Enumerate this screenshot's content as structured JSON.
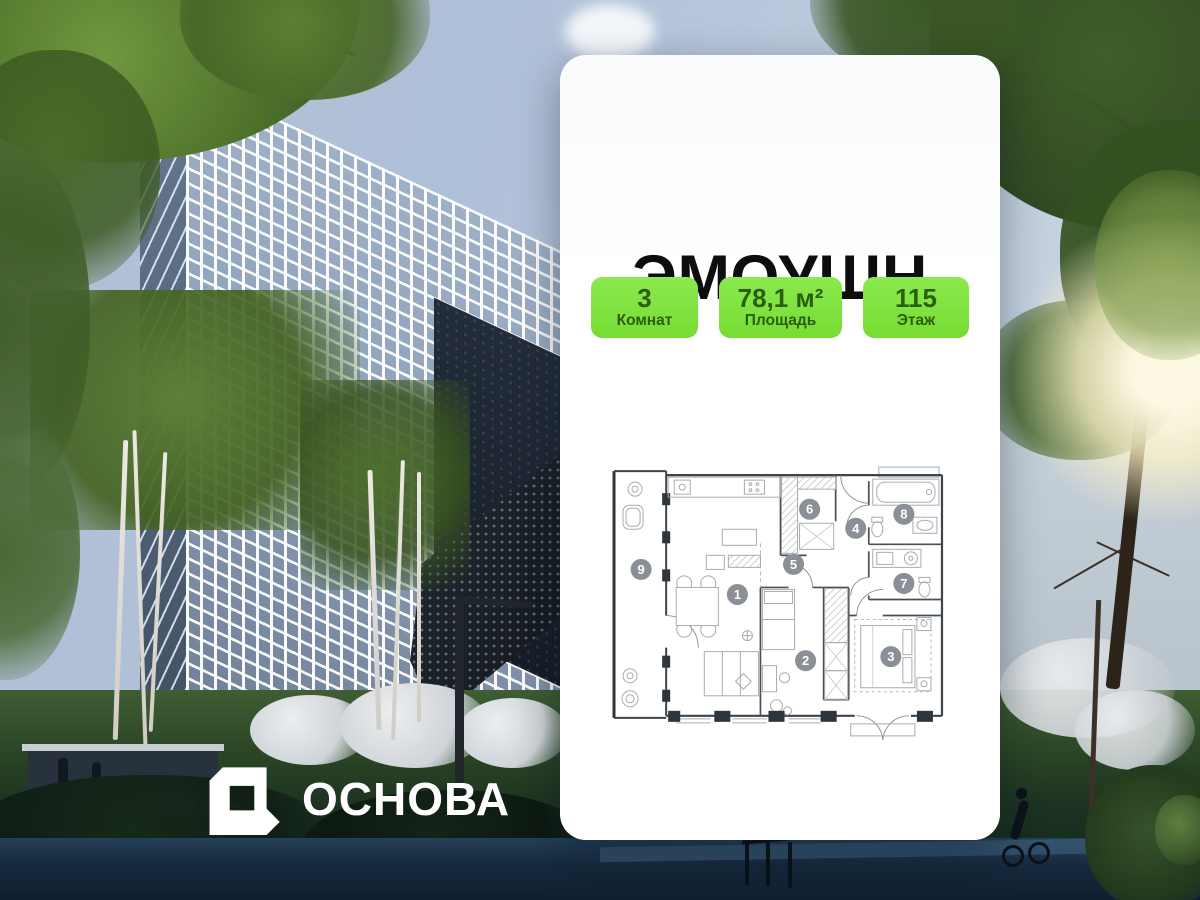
{
  "card": {
    "title": "ЭМОУШН",
    "badges": [
      {
        "value": "3",
        "label": "Комнат"
      },
      {
        "value": "78,1 м²",
        "label": "Площадь"
      },
      {
        "value": "115",
        "label": "Этаж"
      }
    ]
  },
  "floorplan": {
    "description": "apartment-plan",
    "rooms": [
      {
        "number": "1",
        "x": 127,
        "y": 129
      },
      {
        "number": "2",
        "x": 195,
        "y": 195
      },
      {
        "number": "3",
        "x": 280,
        "y": 191
      },
      {
        "number": "4",
        "x": 245,
        "y": 63
      },
      {
        "number": "5",
        "x": 183,
        "y": 99
      },
      {
        "number": "6",
        "x": 199,
        "y": 44
      },
      {
        "number": "7",
        "x": 293,
        "y": 118
      },
      {
        "number": "8",
        "x": 293,
        "y": 49
      },
      {
        "number": "9",
        "x": 31,
        "y": 104
      }
    ]
  },
  "brand": {
    "name": "ОСНОВА"
  },
  "colors": {
    "badge_bg": "#77DC33",
    "badge_bg_light": "#8BE94F",
    "badge_text": "#2A5F10",
    "title": "#0C0D0E",
    "room_marker": "#8B9096",
    "brand_text": "#FFFFFF"
  }
}
